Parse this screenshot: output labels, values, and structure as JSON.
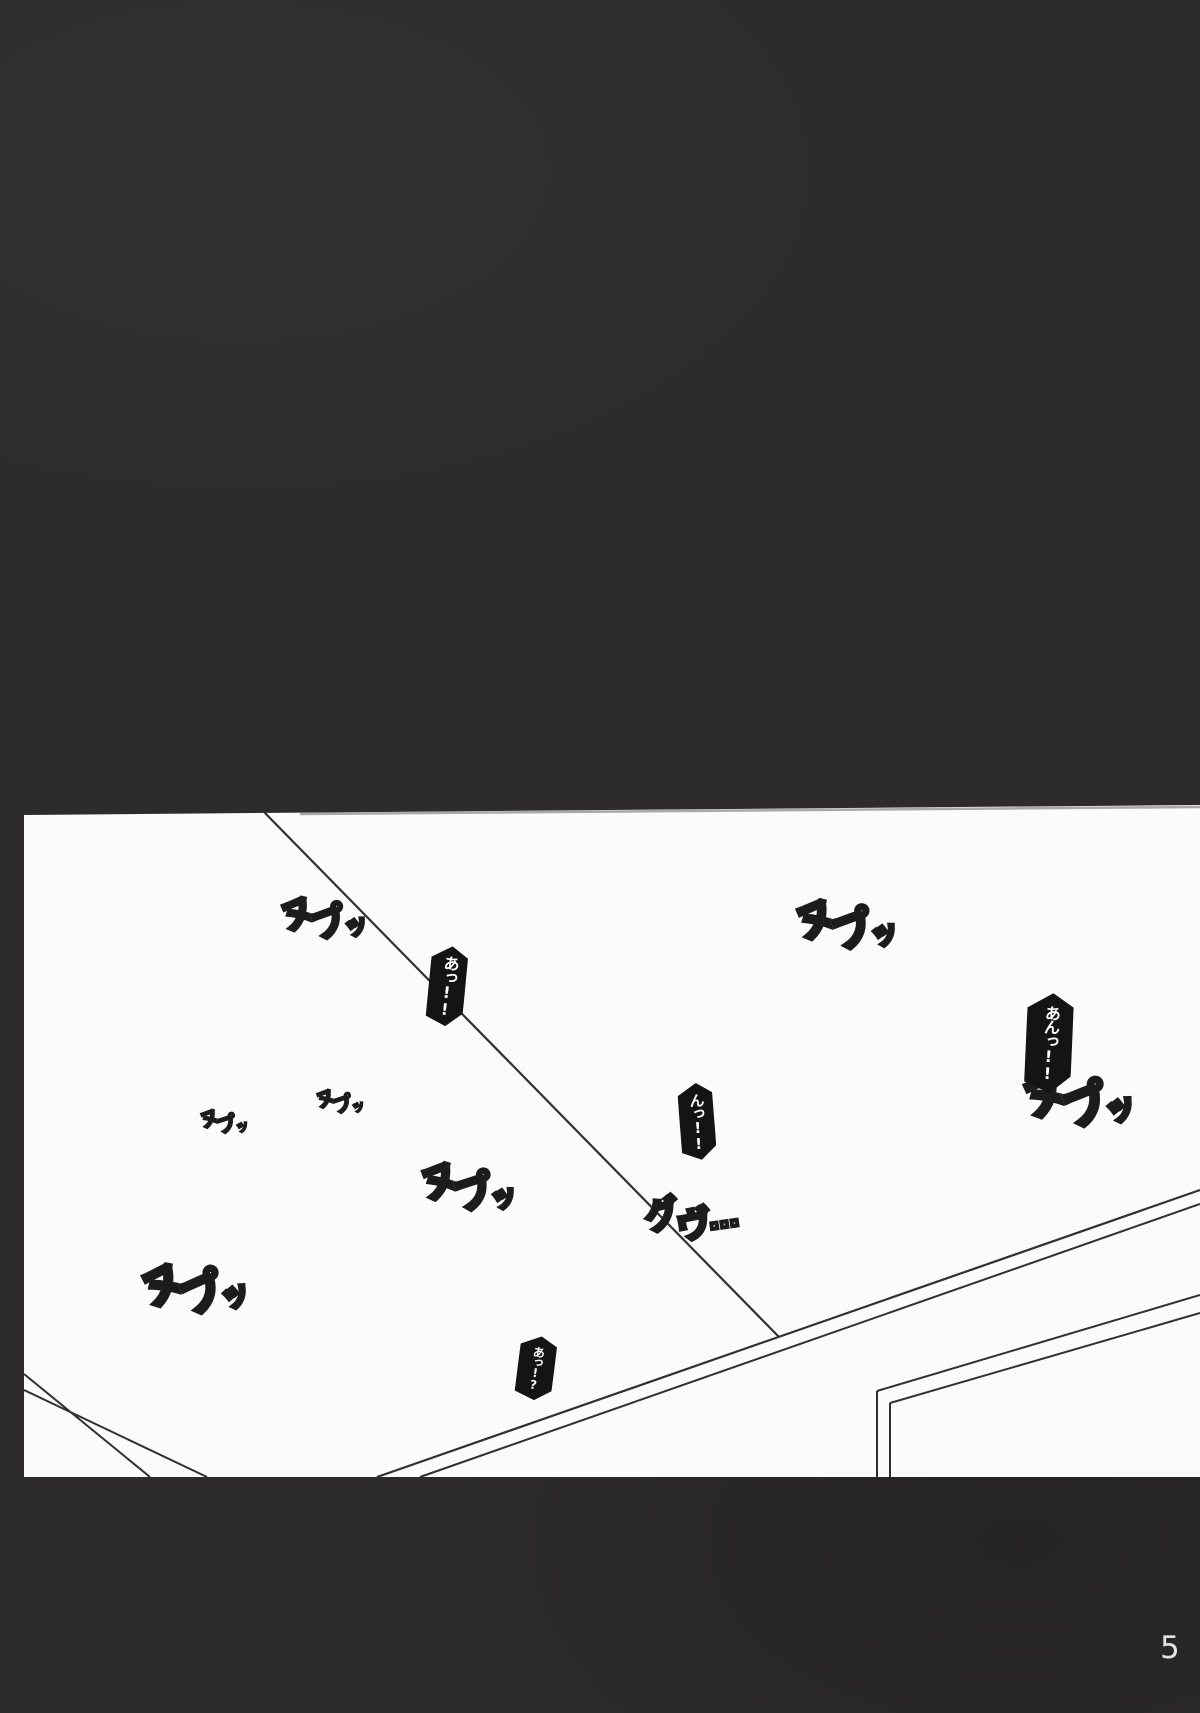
{
  "page": {
    "number_label": "5"
  },
  "colors": {
    "background": "#2d2b2b",
    "panel": "#fbfbfb",
    "line": "#303030",
    "shadow_line": "#9a9a9a",
    "bubble_fill": "#141414",
    "bubble_text": "#ffffff",
    "sfx_outline": "#1c1c1c",
    "sfx_gradient_start": "#ffffff",
    "sfx_gradient_end": "#8a8a8a",
    "page_number": "#e3e3e3"
  },
  "sfx": [
    {
      "id": "nupu-top-left",
      "text": "ヌプッ",
      "chars": [
        "ヌ",
        "プ",
        "ッ"
      ]
    },
    {
      "id": "nupu-small-left",
      "text": "ヌプッ",
      "chars": [
        "ヌ",
        "プ",
        "ッ"
      ]
    },
    {
      "id": "nupu-small-mid",
      "text": "ヌプッ",
      "chars": [
        "ヌ",
        "プ",
        "ッ"
      ]
    },
    {
      "id": "nupu-top-right",
      "text": "ヌプッ",
      "chars": [
        "ヌ",
        "プ",
        "ッ"
      ]
    },
    {
      "id": "nupu-mid",
      "text": "ヌプッ",
      "chars": [
        "ヌ",
        "プ",
        "ッ"
      ]
    },
    {
      "id": "nupu-right-big",
      "text": "ヌプッ",
      "chars": [
        "ヌ",
        "プ",
        "ッ"
      ]
    },
    {
      "id": "guvu",
      "text": "グヴ…",
      "chars": [
        "グ",
        "ヴ",
        "…"
      ]
    },
    {
      "id": "nupu-bottom-left",
      "text": "ヌプッ",
      "chars": [
        "ヌ",
        "プ",
        "ッ"
      ]
    }
  ],
  "bubbles": [
    {
      "id": "gasp-a",
      "text": "あっ!!"
    },
    {
      "id": "gasp-an",
      "text": "あんっ!!"
    },
    {
      "id": "gasp-n",
      "text": "んっ!!"
    },
    {
      "id": "gasp-au",
      "text": "あっ!?"
    }
  ]
}
